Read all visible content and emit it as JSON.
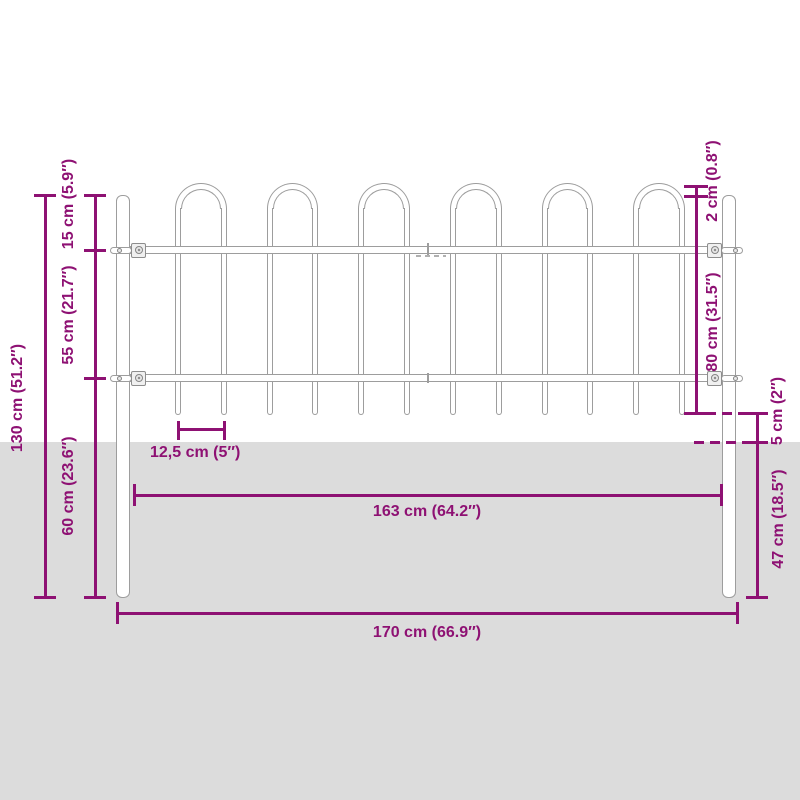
{
  "meta": {
    "type": "product-dimension-diagram",
    "subject": "garden fence panel with hoop top and posts"
  },
  "style": {
    "dimension_color": "#8e1173",
    "fence_line_color": "#9d9d9d",
    "ground_color": "#dcdcdc",
    "background_color": "#ffffff"
  },
  "fence": {
    "hoop_count": 6,
    "bar_count": 12,
    "post_count": 2,
    "rail_count": 2
  },
  "dimensions": {
    "total_height": "130 cm (51.2″)",
    "hoop_section_height": "15 cm (5.9″)",
    "rail_to_rail": "55 cm (21.7″)",
    "lower_section_height": "60 cm (23.6″)",
    "hoop_above_post": "2 cm (0.8″)",
    "panel_height": "80 cm (31.5″)",
    "bar_end_to_ground": "5 cm (2″)",
    "underground_depth": "47 cm (18.5″)",
    "bar_spacing": "12,5 cm (5″)",
    "inner_width": "163 cm (64.2″)",
    "total_width": "170 cm (66.9″)"
  }
}
